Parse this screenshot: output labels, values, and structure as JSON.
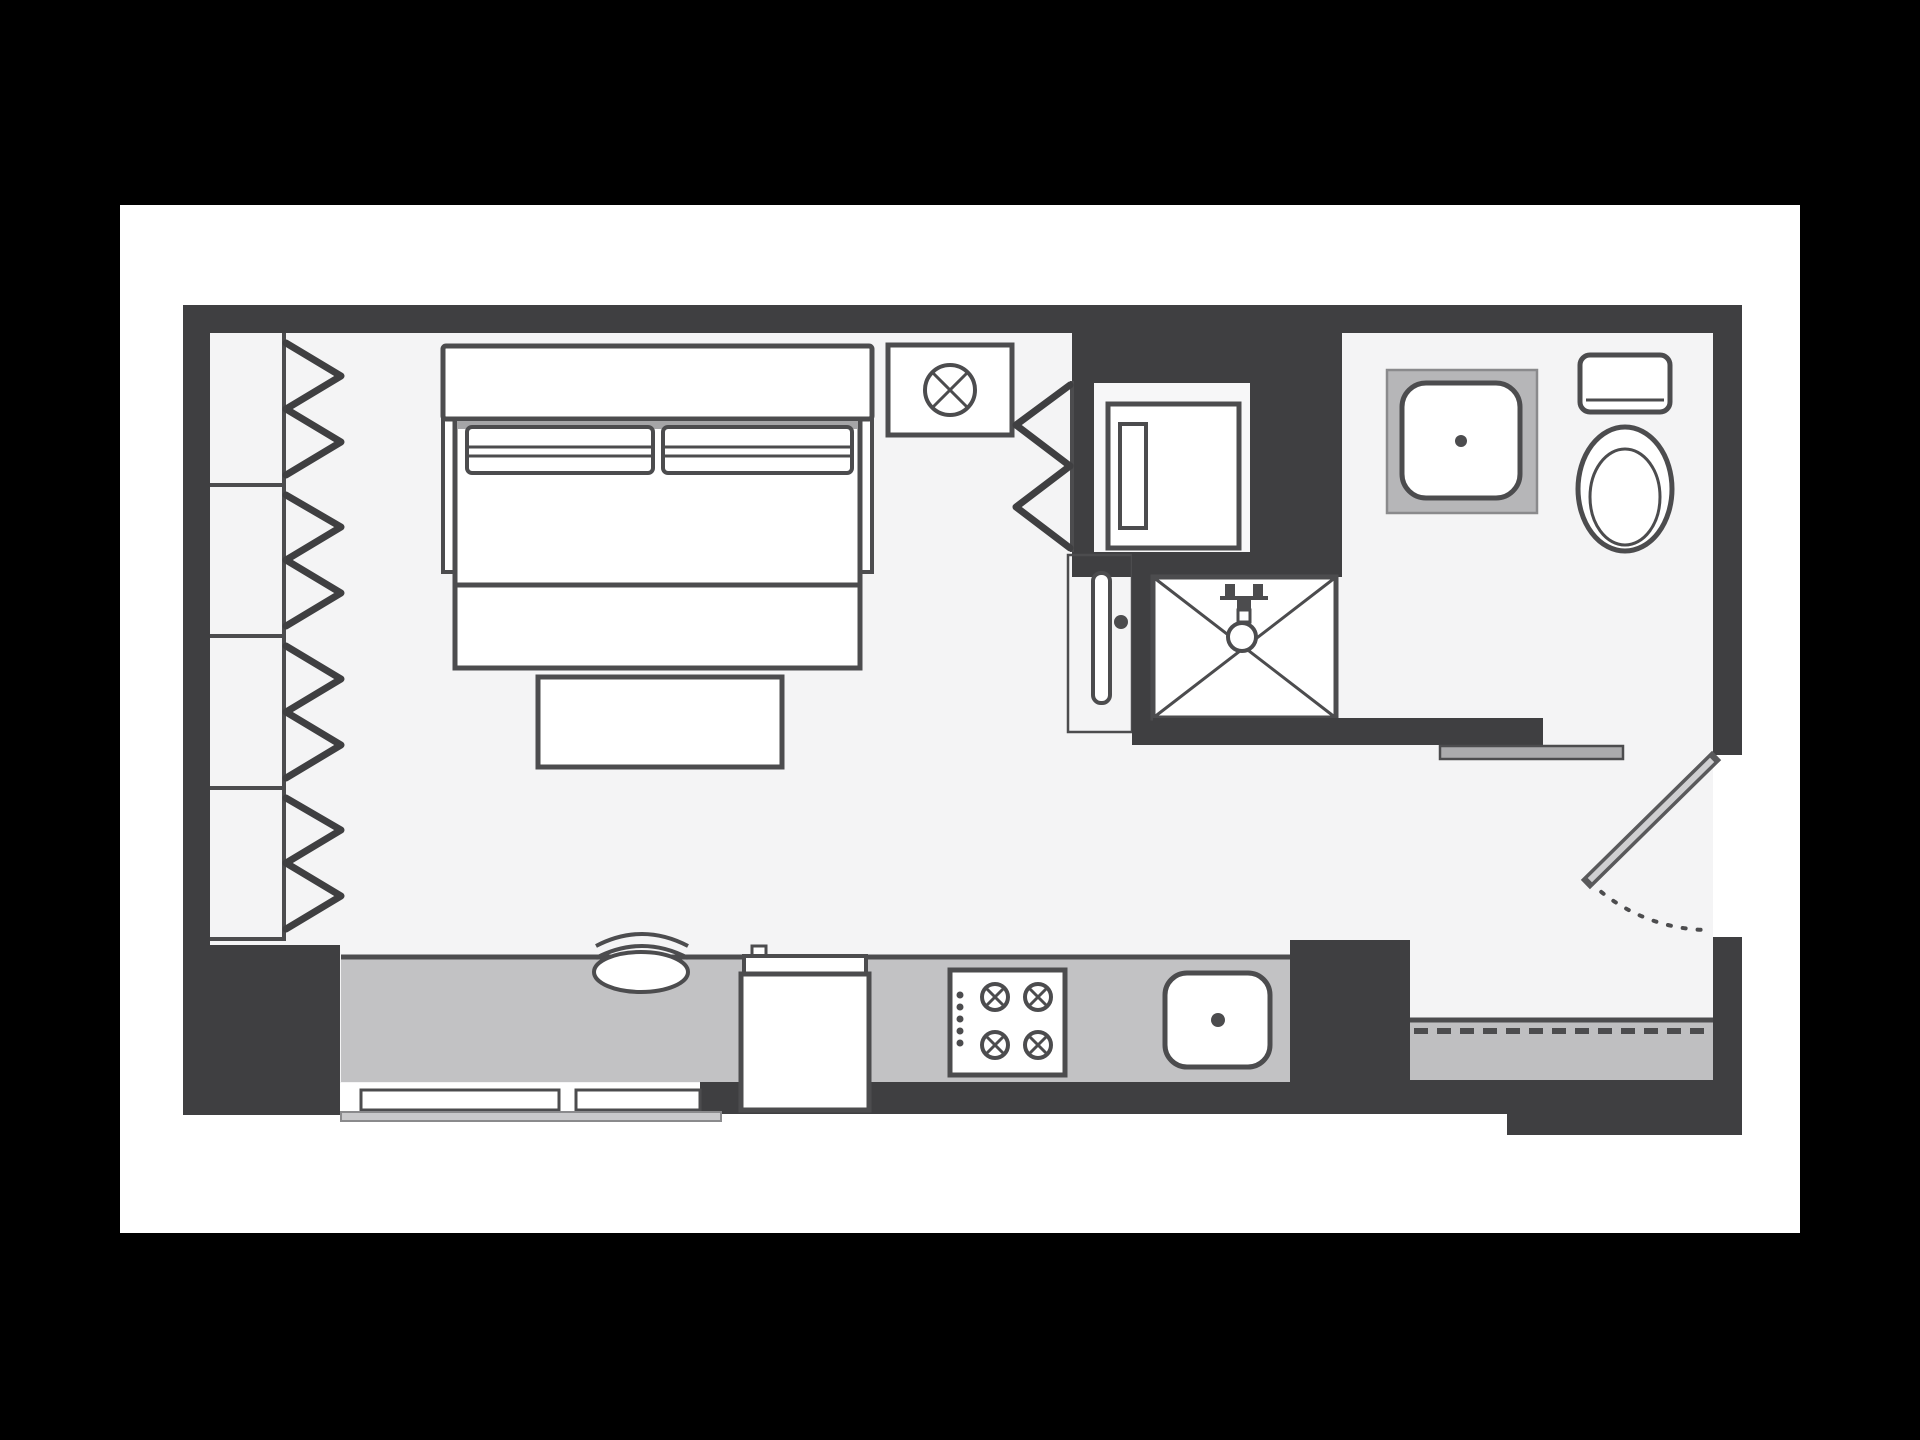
{
  "colors": {
    "background": "#000000",
    "page": "#ffffff",
    "floor": "#f4f4f5",
    "nook_floor": "#f7f7f8",
    "wall": "#3f3f41",
    "line": "#4c4c4e",
    "seam": "#a5a5a7",
    "counter": "#c2c2c4",
    "entry_floor": "#bfbfc1",
    "bath_counter": "#b6b6b8",
    "counter_edge": "#8a8a8c",
    "shelf": "#ababad",
    "kick_strip": "#c9c9cb",
    "fixture": "#ffffff",
    "leaf_edge": "#59595b",
    "leaf_fill": "#cfcfd1"
  },
  "fixtures": [
    "bifold-closet",
    "bed",
    "pillows",
    "bench",
    "ceiling-light",
    "laundry-closet",
    "washer",
    "sliding-door",
    "shower",
    "bathroom-sink",
    "toilet",
    "ledge-shelf",
    "kitchen-counter",
    "base-cabinets",
    "refrigerator",
    "cooktop",
    "kitchen-sink",
    "stool",
    "entry-door",
    "entry-threshold"
  ]
}
